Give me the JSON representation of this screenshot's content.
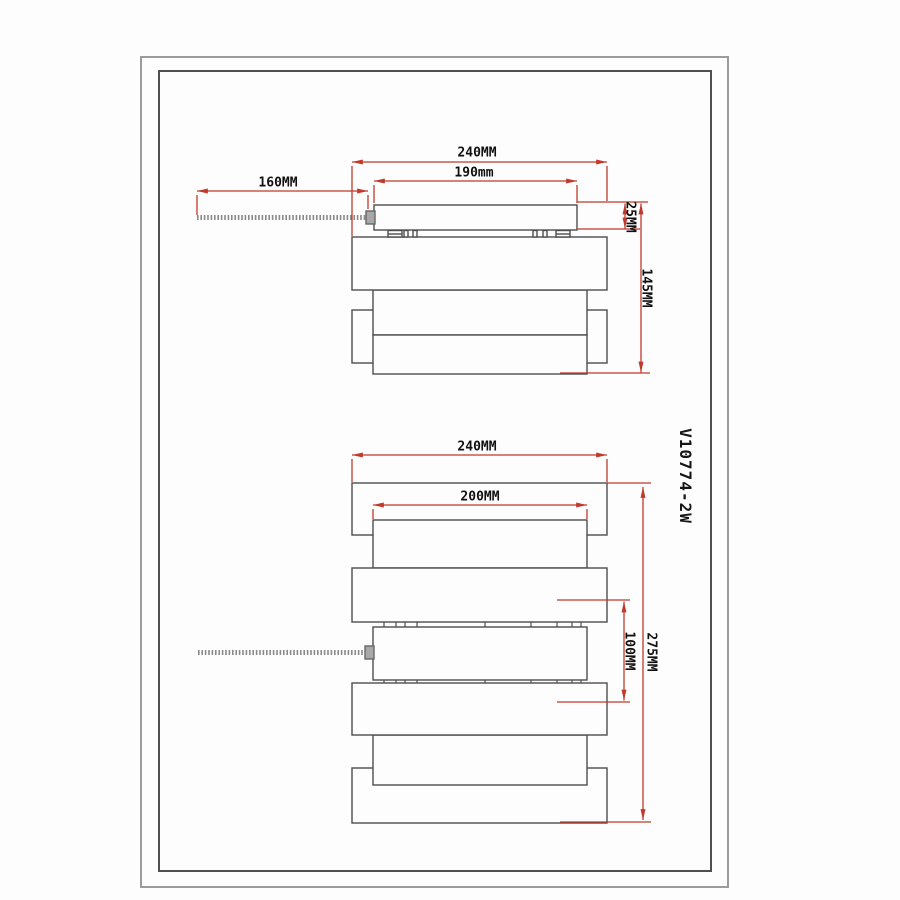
{
  "drawing": {
    "product_code": "V10774-2W",
    "top_view": {
      "overall_width": "240MM",
      "canopy_width": "190mm",
      "arm_length": "160MM",
      "canopy_thickness": "25MM",
      "total_depth": "145MM"
    },
    "front_view": {
      "overall_width": "240MM",
      "inner_width": "200MM",
      "overall_height": "275MM",
      "slat_spacing": "100MM"
    }
  },
  "colors": {
    "dimension_red": "#c0392b",
    "line_dark": "#4d4d4d",
    "frame_outer": "#9b9b9b",
    "frame_inner": "#4f4f4f"
  }
}
